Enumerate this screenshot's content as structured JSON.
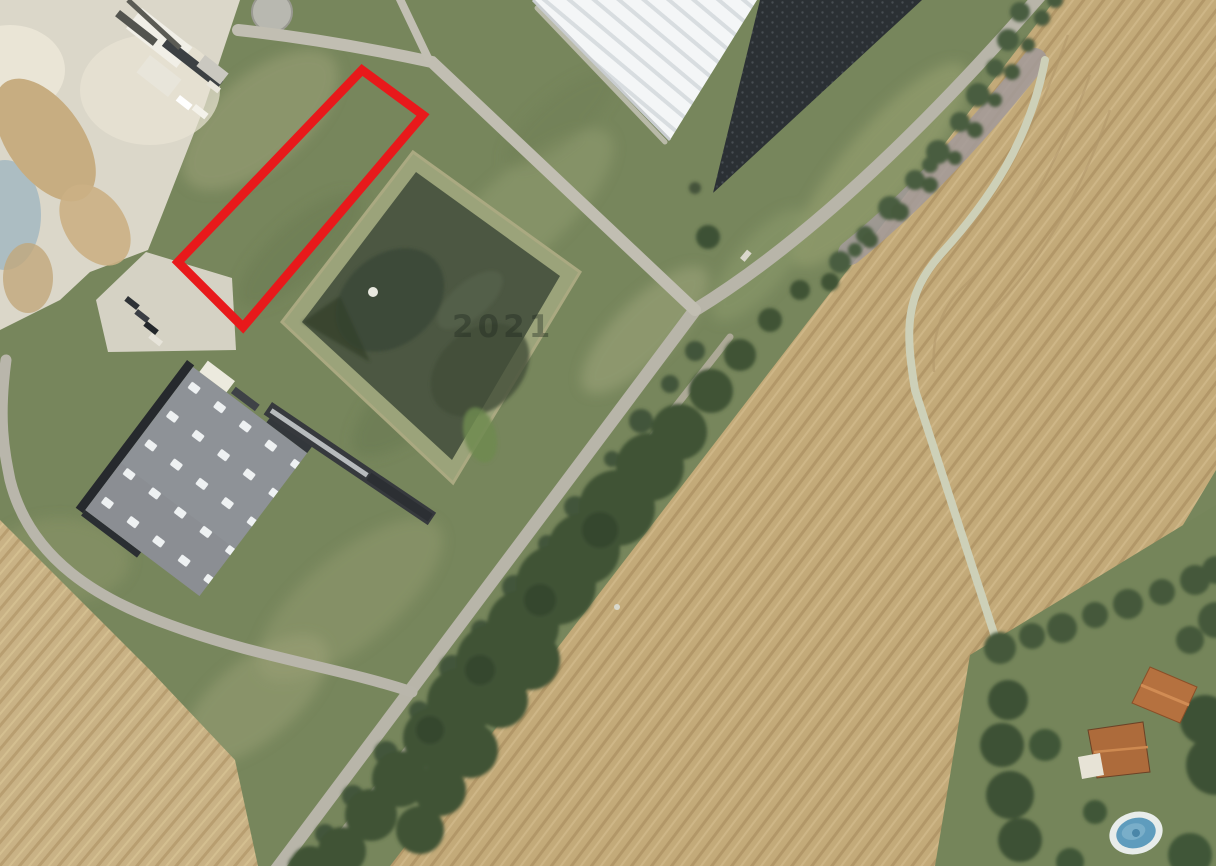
{
  "map": {
    "watermark": "2021"
  },
  "palette": {
    "parcel_outline": "#e8191b",
    "watermark_fill": "rgba(28,38,28,0.42)",
    "grass": "#77865c",
    "field": "#c3aa79",
    "field_bottom_left": "#c9b285",
    "basin_water": "#4c5742",
    "basin_berm": "#9ba37a",
    "warehouse_roof": "#f4f6f7",
    "factory_roof": "#8e9297",
    "dark_depot": "#2b3034",
    "road": "#b8b5a9",
    "trees": "#3f5336",
    "house_roof": "#b5713f",
    "pool_water": "#5f9cbd",
    "industrial_ground": "#dbd7c9"
  }
}
